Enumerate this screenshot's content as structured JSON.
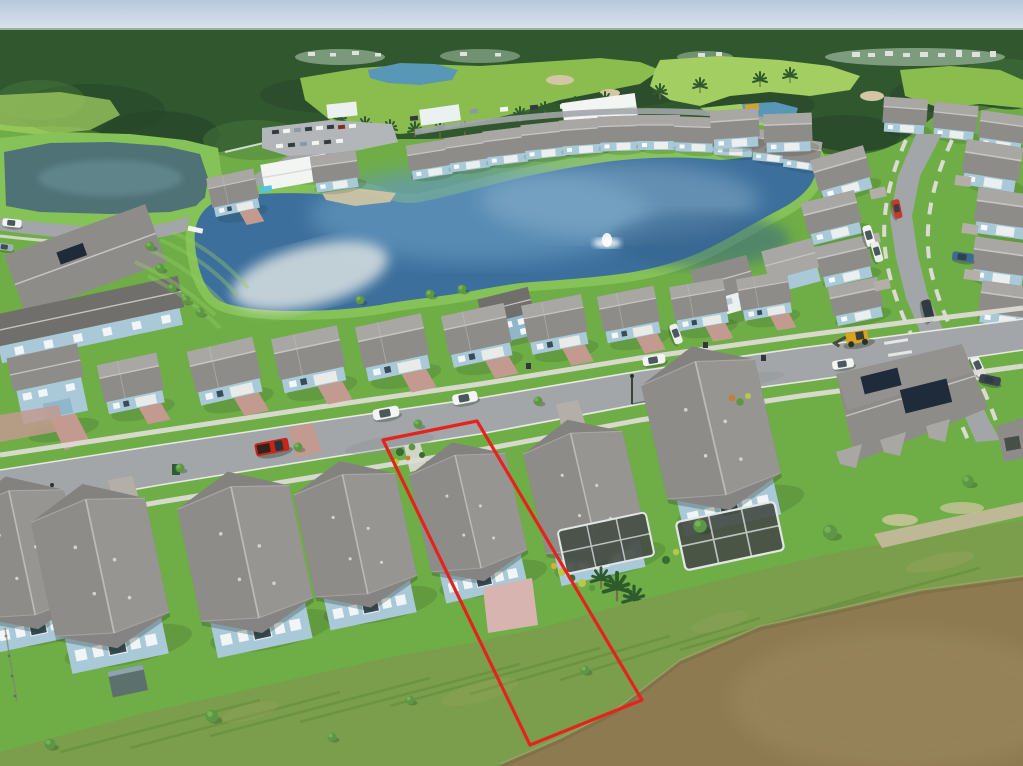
{
  "meta": {
    "type": "aerial-drone-photograph",
    "description": "Aerial view of a Florida-style suburban lake community: tree line and golf course at the horizon, a large blue community lake ringed by gray-roofed single-family homes, a main street with parked vehicles, a curving side road, houses with screened pool lanais, a long roof with solar panels, and a muddy retention pond in the foreground. One waterfront parcel is outlined in red."
  },
  "colors": {
    "sky_top": "#b7c8dc",
    "sky_low": "#e9eef4",
    "haze": "#ccd8cc",
    "forest": "#31572f",
    "forest_dark": "#27462a",
    "forest_light": "#4b7d3e",
    "forest_haze": "#8aa98c",
    "fairway": "#8abd4e",
    "fairway_light": "#a2ce62",
    "golf_pond": "#5897b6",
    "pond_teal": "#4f7277",
    "pond_teal_light": "#6d949b",
    "lake_deep": "#3c6f9c",
    "lake_mid": "#6397bd",
    "lake_light": "#9fc0d4",
    "reflect": "#e3e8e6",
    "pond_brown": "#8d7a50",
    "pond_brown_light": "#9c8a60",
    "pond_brown_dark": "#75653e",
    "grass": "#6fae46",
    "grass_bright": "#85c257",
    "grass_dark": "#55903a",
    "stripe": "#93cb64",
    "scrub": "#7a9e4c",
    "scrub_dark": "#5a8636",
    "dry": "#a8a465",
    "dirt": "#c2b89c",
    "sand": "#d3c6a4",
    "asphalt": "#a2a6a9",
    "asphalt_dark": "#898e92",
    "concrete": "#dbdbd4",
    "curb": "#e9e9e3",
    "paver_pink": "#c29a90",
    "paver_gray": "#b3aea7",
    "patio": "#d8b4b0",
    "roof": "#8e8c89",
    "roof_light": "#a9a7a3",
    "roof_dark": "#716f6c",
    "ridge": "#c8c5c0",
    "wall": "#a9c9d8",
    "wall_white": "#ebf0f1",
    "wall_blue": "#8fb6c9",
    "window": "#3a4b57",
    "screen": "#474f46",
    "screen_frame": "#e2e6e6",
    "solar": "#1f2a3a",
    "red": "#e5231c",
    "car_white": "#f3f5f4",
    "car_dark": "#333b41",
    "car_red": "#c8241a",
    "car_blue": "#3e6b90",
    "machine": "#d7a322",
    "tree": "#3c6a33",
    "tree_light": "#5d9743",
    "palm": "#2e5a2d",
    "shadow": "#1e3220"
  },
  "overlay": {
    "lot_outline_points": "383,440 477,421 642,700 530,745"
  },
  "scene": {
    "landmarks": [
      "hazy sky band",
      "distant tree line with far-off white buildings",
      "golf course fairways with palm trees, sand bunkers and two blue ponds",
      "clubhouse buildings with parking lot full of cars",
      "teal retention pond with small white dock and shore road",
      "large blue community lake with fountain spray and sandy cove",
      "rows of gray-roofed houses around the lake",
      "main street with red pickup truck, white SUVs and sidewalks",
      "curving north-south street with parked vans and cars",
      "yellow construction loader on the street",
      "long roof with dark solar panels",
      "houses with dark screened pool lanais",
      "pink paver driveways and patio",
      "mowed lawns with young trees",
      "rough unmowed slope with planting rows",
      "muddy brown pond with dirt shoreline path",
      "red property boundary outline around waterfront lot"
    ]
  }
}
